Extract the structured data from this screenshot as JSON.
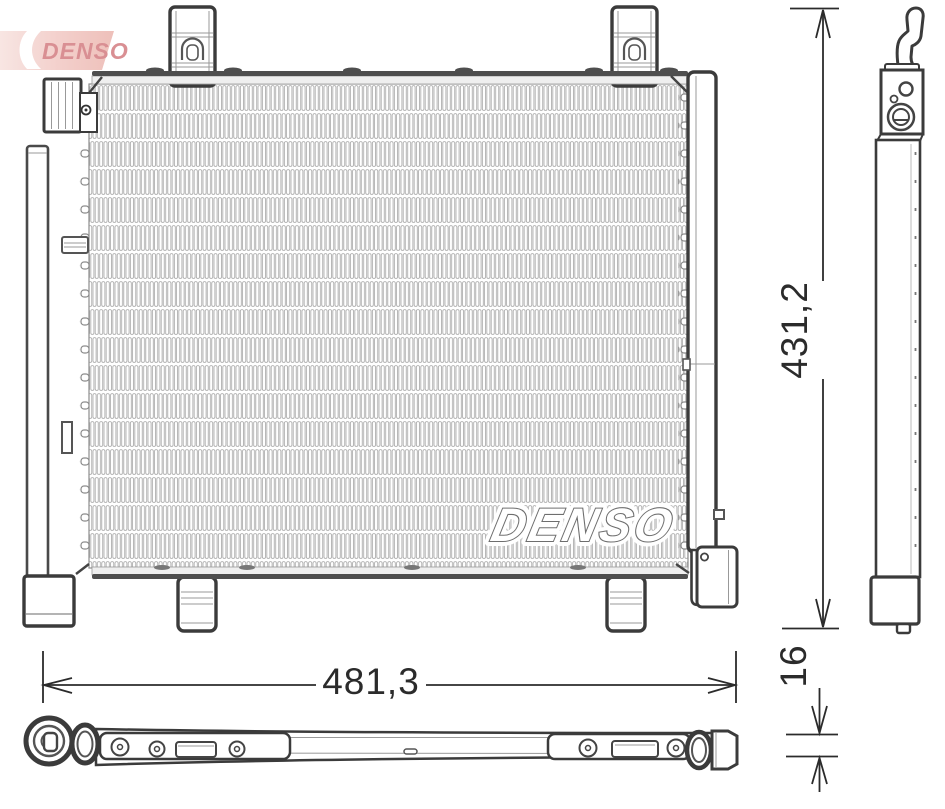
{
  "page": {
    "background": "#ffffff"
  },
  "logo": {
    "text": "DENSO",
    "field_color_left": "#f8e7e4",
    "field_color_right": "#eec0ba",
    "text_color": "#d98f93",
    "swoosh_color": "#ffffff"
  },
  "watermark": {
    "text": "DENSO"
  },
  "dimensions": {
    "width_label": "481,3",
    "height_label": "431,2",
    "depth_label": "16"
  },
  "drawing": {
    "outline_color": "#3b3b3b",
    "detail_line_color": "#999999",
    "fin_line_color": "#a6a6a6",
    "dimension_line_color": "#2b2b2b",
    "bar_fill_color": "#4e4e4e"
  }
}
